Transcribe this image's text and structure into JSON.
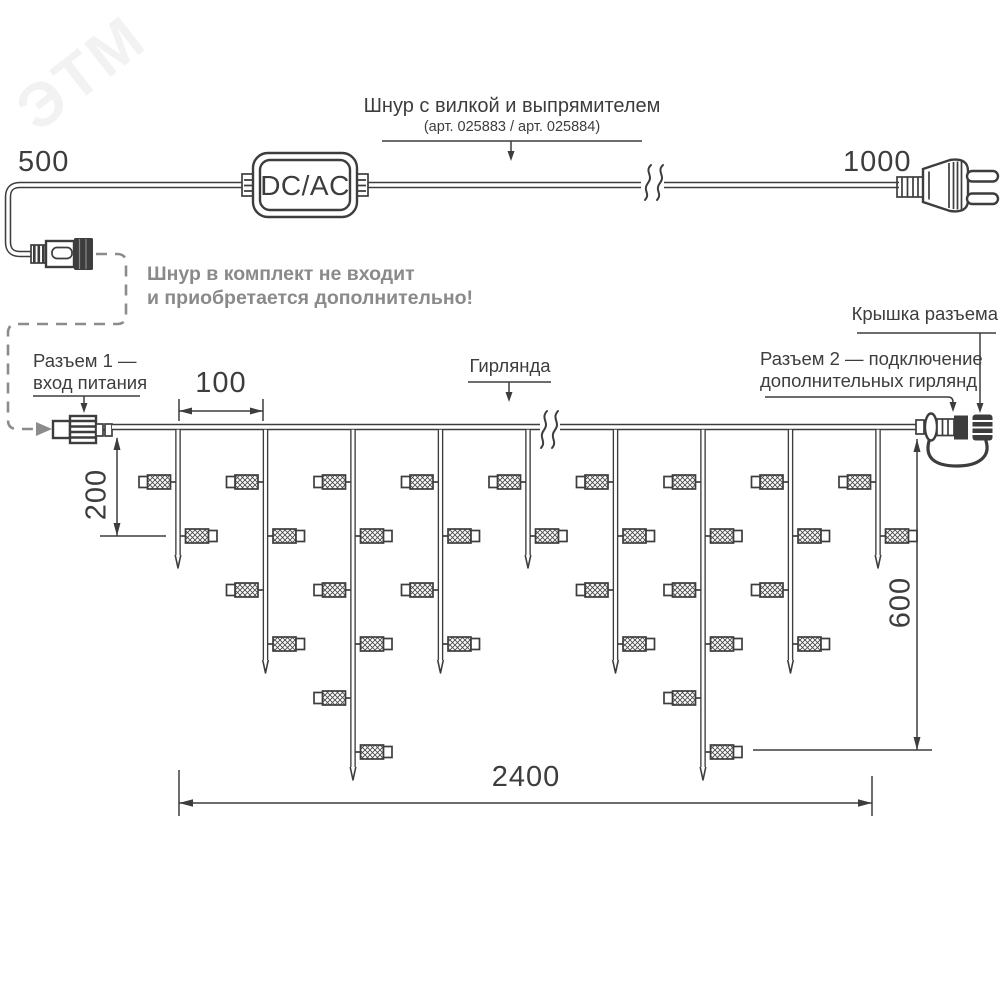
{
  "watermark_text": "ЭТМ",
  "colors": {
    "line": "#3d3d3d",
    "gray": "#8a8a8a",
    "watermark": "#f2f2f2",
    "background": "#ffffff"
  },
  "labels": {
    "cord_title": "Шнур с вилкой и выпрямителем",
    "cord_articles": "(арт. 025883 / арт. 025884)",
    "converter": "DC/AC",
    "note_line1": "Шнур в комплект не входит",
    "note_line2": "и приобретается дополнительно!",
    "connector1_line1": "Разъем 1 —",
    "connector1_line2": "вход питания",
    "garland": "Гирлянда",
    "connector2_line1": "Разъем 2 — подключение",
    "connector2_line2": "дополнительных гирлянд",
    "cap": "Крышка разъема"
  },
  "dimensions_mm": {
    "cord_to_connector": "500",
    "cord_to_plug": "1000",
    "drop_spacing": "100",
    "short_drop": "200",
    "long_drop": "600",
    "total_width": "2400"
  },
  "diagram": {
    "type": "icicle-garland-technical-drawing",
    "wire_y": 427,
    "drop_start_x": 178,
    "drop_spacing_px": 87.5,
    "drop_sizes": [
      "short",
      "medium",
      "long",
      "medium",
      "short",
      "medium",
      "long",
      "medium",
      "short"
    ],
    "tip_y": {
      "short": 568,
      "medium": 673,
      "long": 780
    },
    "bulb_counts": {
      "short": 2,
      "medium": 4,
      "long": 6
    },
    "bulb_rows": [
      {
        "y": 482,
        "side": "left"
      },
      {
        "y": 536,
        "side": "right"
      },
      {
        "y": 590,
        "side": "left"
      },
      {
        "y": 644,
        "side": "right"
      },
      {
        "y": 698,
        "side": "left"
      },
      {
        "y": 752,
        "side": "right"
      }
    ]
  }
}
